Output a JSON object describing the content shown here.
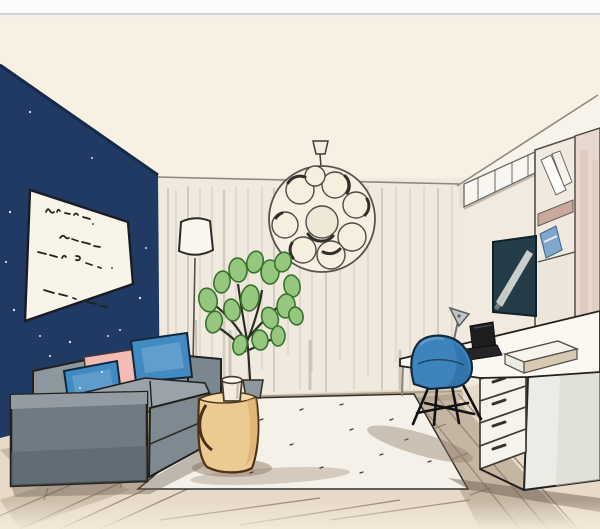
{
  "scene": {
    "title": "Watercolor marker sketch of a living room with navy accent wall, gray sofa and home-office desk",
    "medium": "hand-drawn interior illustration",
    "objects": [
      "navy accent wall",
      "handwritten art print",
      "floor lamp",
      "sheer curtains",
      "bubble pendant light",
      "gray sofa",
      "blue throw pillows",
      "pink throw pillow",
      "potted plant",
      "tan ottoman side table",
      "mug",
      "white area rug",
      "wood plank floor",
      "blue desk chair",
      "white desk with drawers",
      "black laptop",
      "desk lamp",
      "white box",
      "wall-mounted tv",
      "upper cabinets",
      "bookshelf with books",
      "tall cabinet"
    ]
  },
  "colors": {
    "paper": "#f6efe2",
    "ceiling": "#f7f1e4",
    "wall_navy": "#203a63",
    "curtain": "#f0eade",
    "curtain_stroke": "#c9c2b7",
    "ceiling_line": "#8f887c",
    "ink": "#23211c",
    "sofa_gray": "#8d979e",
    "sofa_dark": "#6e7a84",
    "sofa_seat": "#99a3a9",
    "pillow_blue": "#428ac2",
    "pillow_pink": "#f3bcb2",
    "ottoman_tan": "#eccb92",
    "plant_green": "#95c87e",
    "plant_dark": "#39722e",
    "chair_blue": "#3d84bd",
    "tv_screen": "#233c47",
    "cabinet_pink": "#e9d8d0",
    "shelf_mauve": "#c8a99e",
    "book_blue": "#7fa8cc",
    "desk_white": "#fbf8f2",
    "drawer_white": "#f5f3ec",
    "wood": "#e8dac8",
    "wood_wash": "#9b8775",
    "wood_shadow": "#6f6052",
    "rug": "#f6f1e8",
    "lamp_metal": "#c3c6c8",
    "photo_border": "#fbfbfb",
    "photo_line": "#d5d5d5"
  }
}
